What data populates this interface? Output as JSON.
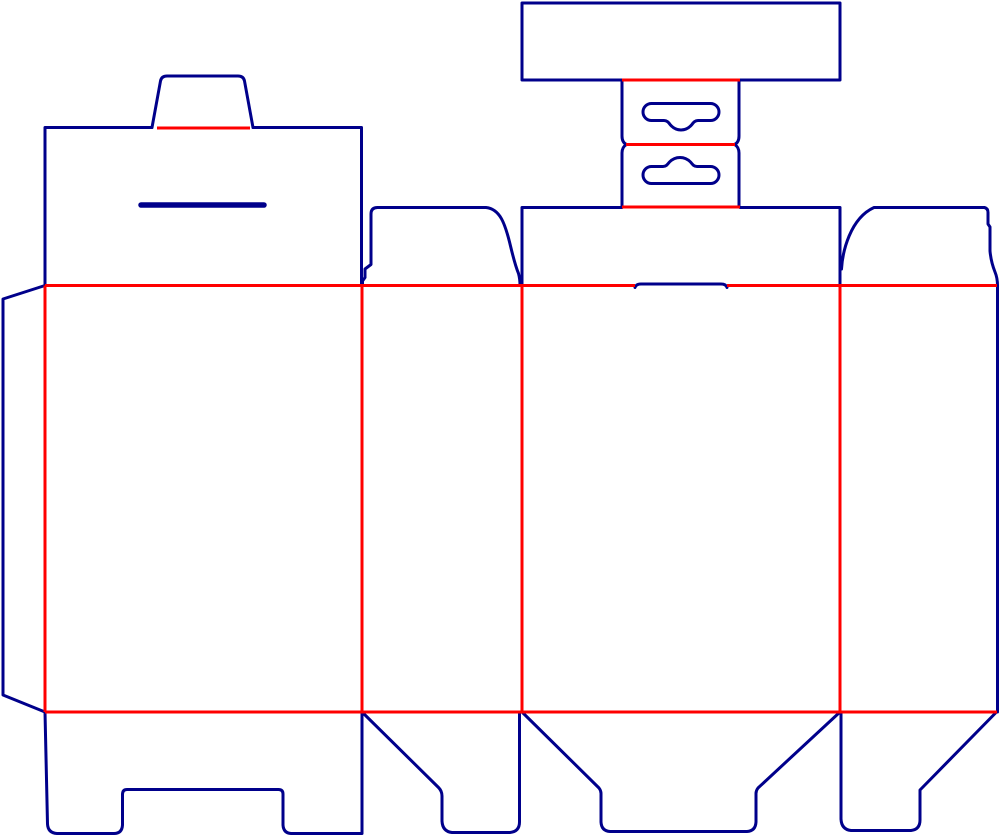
{
  "diagram": {
    "type": "packaging-dieline",
    "canvas": {
      "width": 1000,
      "height": 836,
      "background": "#FFFFFF"
    },
    "line_styles": {
      "cut": {
        "color": "#00008B",
        "width": 3,
        "meaning": "cut line"
      },
      "crease": {
        "color": "#FF0000",
        "width": 3,
        "meaning": "crease / fold line"
      },
      "slit": {
        "color": "#00008B",
        "width": 5.5,
        "meaning": "slit cut"
      }
    },
    "creases": [
      {
        "name": "tuck-tab-fold",
        "x1": 157,
        "y1": 128,
        "x2": 250,
        "y2": 128
      },
      {
        "name": "header-to-hang-tab-fold",
        "x1": 622,
        "y1": 80,
        "x2": 740,
        "y2": 80
      },
      {
        "name": "hang-tab-middle-fold",
        "x1": 626,
        "y1": 144.5,
        "x2": 735,
        "y2": 144.5
      },
      {
        "name": "hang-tab-to-flap-fold",
        "x1": 622,
        "y1": 207,
        "x2": 740,
        "y2": 207
      },
      {
        "name": "top-crease-left",
        "x1": 45,
        "y1": 285.5,
        "x2": 635,
        "y2": 285.5
      },
      {
        "name": "top-crease-right",
        "x1": 727,
        "y1": 285.5,
        "x2": 997,
        "y2": 285.5
      },
      {
        "name": "bottom-crease",
        "x1": 45,
        "y1": 712,
        "x2": 997,
        "y2": 712
      },
      {
        "name": "glue-flap-fold",
        "x1": 45,
        "y1": 285.5,
        "x2": 45,
        "y2": 712
      },
      {
        "name": "panel1-panel2-fold",
        "x1": 362,
        "y1": 285.5,
        "x2": 362,
        "y2": 712
      },
      {
        "name": "panel2-panel3-fold",
        "x1": 522,
        "y1": 285.5,
        "x2": 522,
        "y2": 712
      },
      {
        "name": "panel3-panel4-fold",
        "x1": 840,
        "y1": 285.5,
        "x2": 840,
        "y2": 712
      }
    ],
    "cuts": [
      {
        "name": "glue-flap-outline",
        "d": "M45,285.5 L3,299 L3,695 L45,712"
      },
      {
        "name": "panel1-lid-left-top-edge",
        "d": "M45,285.5 L45,127.5 L152,127.5"
      },
      {
        "name": "panel1-lid-right-edge",
        "d": "M253,127.5 L361.5,127.5 L361.5,285.5"
      },
      {
        "name": "panel1-tuck-tab",
        "d": "M152,127.5 L160.5,81 Q161.5,76 167,76 L238,76 Q243.5,76 244.5,81 L253,127.5"
      },
      {
        "name": "panel2-top-flap",
        "d": "M362.5,285.5 L362.5,281 L365,277.5 L365,269 L371,264.5 L371,214 Q371,207.5 377.5,207.5 L486,207.5 C500,209 505,223 510.5,246 C513.5,258.5 516,267.5 518.5,273.5 Q520,279 520,285.5"
      },
      {
        "name": "panel3-top-flap-left-edge",
        "d": "M522,285.5 L522,207.5 L622,207.5"
      },
      {
        "name": "panel3-top-flap-right-edge",
        "d": "M740,207.5 L840,207.5 L840,285.5"
      },
      {
        "name": "tuck-lock-slit",
        "d": "M635,287.5 Q636,284 641,284 L721,284 Q726,284 727,287.5"
      },
      {
        "name": "header-card-outline",
        "d": "M622,80 L522,80 L522,3 L840,3 L840,80 L740,80"
      },
      {
        "name": "hang-tab-upper-left-edge",
        "d": "M622,80 L622,136 Q622,142.5 626.5,144.5"
      },
      {
        "name": "hang-tab-upper-right-edge",
        "d": "M739,80 L739,136 Q739,142.5 734.5,144.5"
      },
      {
        "name": "hang-tab-lower-left-edge",
        "d": "M626.5,144.5 Q622,147 622,153 L622,207"
      },
      {
        "name": "hang-tab-lower-right-edge",
        "d": "M734.5,144.5 Q739,147 739,153 L739,207"
      },
      {
        "name": "euro-slot-upper",
        "d": "M651.5,103.5 L710.5,103.5 A8.5,8.5 0 0 1 710.5,120.5 L698,120.5 C695,120.5 693.5,122.5 691.5,125 Q687,130 681,130 Q675,130 670.5,125 C668.5,122.5 667,120.5 664,120.5 L651.5,120.5 A8.5,8.5 0 0 1 651.5,103.5 Z"
      },
      {
        "name": "euro-slot-lower",
        "d": "M651.5,183.5 L710.5,183.5 A8.5,8.5 0 0 0 710.5,166.5 L697,166.5 C694,166.5 692.5,164.5 690.5,162 Q686,157.5 680,157.5 Q674,157.5 669.5,162 C667.5,164.5 666,166.5 663,166.5 L651.5,166.5 A8.5,8.5 0 0 0 651.5,183.5 Z"
      },
      {
        "name": "panel4-top-flap",
        "d": "M841.5,269 C842.5,252 850,218.5 874,207.5 L984.5,207.5 Q988,208.5 988,212.5 L988,224 L990,227 L990,251 Q991,262 995,272 Q997.5,278 997.5,285.5"
      },
      {
        "name": "panel4-right-edge",
        "d": "M997.5,285.5 L997.5,712"
      },
      {
        "name": "bottom-flap-1-notched",
        "d": "M362,712 L362,833.5 L291,833.5 Q283.5,833 283,825 L283,794 Q283,789.5 278.5,789.5 L127,789.5 Q122.5,789.5 122.5,794.5 L122.5,825 Q122,833.5 114,833.5 L57,833.5 Q48,833 47.5,824 L45,712"
      },
      {
        "name": "bottom-flap-2",
        "d": "M362,712 L438.5,787.5 Q442,791 442,796 L442,821 Q442.5,831.5 452,832.5 L510,832.5 Q519.5,831.5 519.5,822 L519.5,712"
      },
      {
        "name": "bottom-flap-3-tapered",
        "d": "M522,712 L599,788 Q601,790.5 601,793.5 L601,822 Q601.5,831 610,831.5 L747,831.5 Q755.5,831 756,822 L756,793.5 Q756,790.5 758,788 L840,712"
      },
      {
        "name": "bottom-flap-4",
        "d": "M841,712 L841,819 Q841.5,829.5 851,830.5 L911,830.5 Q920,829.5 920,820 L920,790 L996.5,712"
      }
    ],
    "slits": [
      {
        "name": "panel1-lid-thumb-slit",
        "x1": 141,
        "y1": 205,
        "x2": 264,
        "y2": 205
      }
    ]
  }
}
